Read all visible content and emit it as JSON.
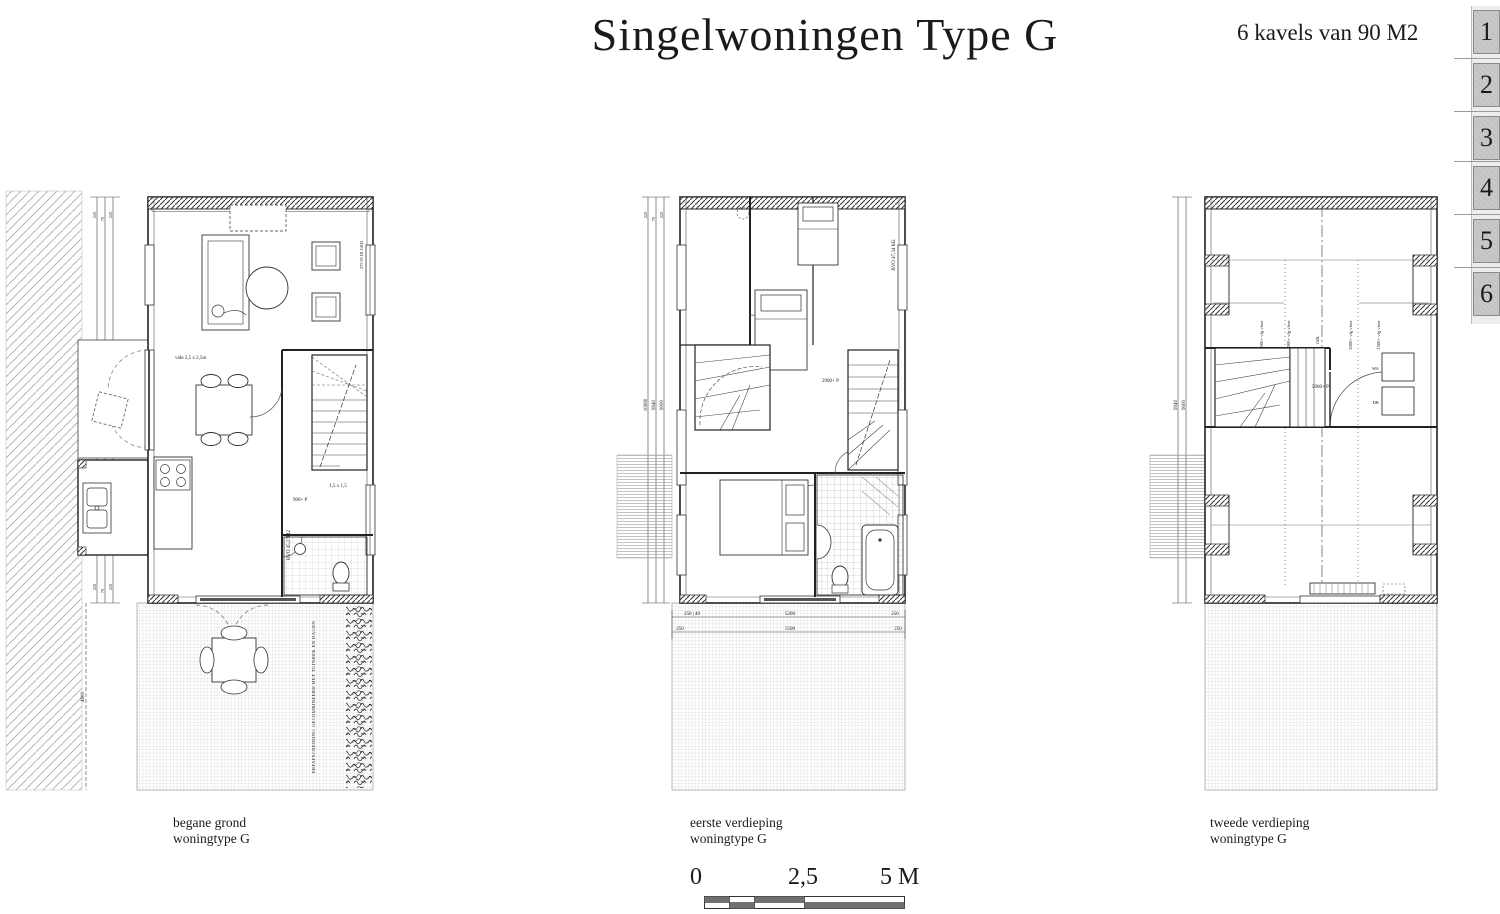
{
  "header": {
    "title": "Singelwoningen Type G",
    "subtitle": "6 kavels van 90 M2"
  },
  "tabs": [
    "1",
    "2",
    "3",
    "4",
    "5",
    "6"
  ],
  "scalebar": {
    "zero": "0",
    "mid": "2,5",
    "end": "5 M"
  },
  "plans": [
    {
      "caption1": "begane grond",
      "caption2": "woningtype G",
      "area": "BVO 45,27M2",
      "level": "900+ P",
      "stair_size": "1,5 x 1,5",
      "vide": "vide 2,5 x 2,5m",
      "window_code": "275 95 D1 GRD",
      "garden_note": "ERFAFSCHEIDING GECOMBINEERD MET TUINHEK EN HAGEN",
      "dim_total": "10080",
      "dim_inner": "9940",
      "dim_room": "9000",
      "dim_garden": "4600",
      "dim_top": [
        "220",
        "70",
        "220"
      ],
      "dim_bottom": [
        "220",
        "70",
        "220"
      ]
    },
    {
      "caption1": "eerste verdieping",
      "caption2": "woningtype G",
      "area": "BVO 47,34 M2",
      "level": "2900+ P",
      "dim_total": "10080",
      "dim_inner": "9940",
      "dim_room": "9000",
      "dim_top": [
        "220",
        "70",
        "220"
      ],
      "dims_row1": [
        "250 | 40",
        "5200",
        "250"
      ],
      "dims_row2": [
        "250",
        "5500",
        "250"
      ]
    },
    {
      "caption1": "tweede verdieping",
      "caption2": "woningtype G",
      "level": "5000+ P",
      "ridge": "nok",
      "knee_labels": [
        "1500+ vlg vloer",
        "2000+ vlg vloer",
        "2000+ vlg vloer",
        "1500+ vlg vloer"
      ],
      "appliances": [
        "WA",
        "DR"
      ],
      "dim_inner": "9940",
      "dim_room": "9000"
    }
  ]
}
